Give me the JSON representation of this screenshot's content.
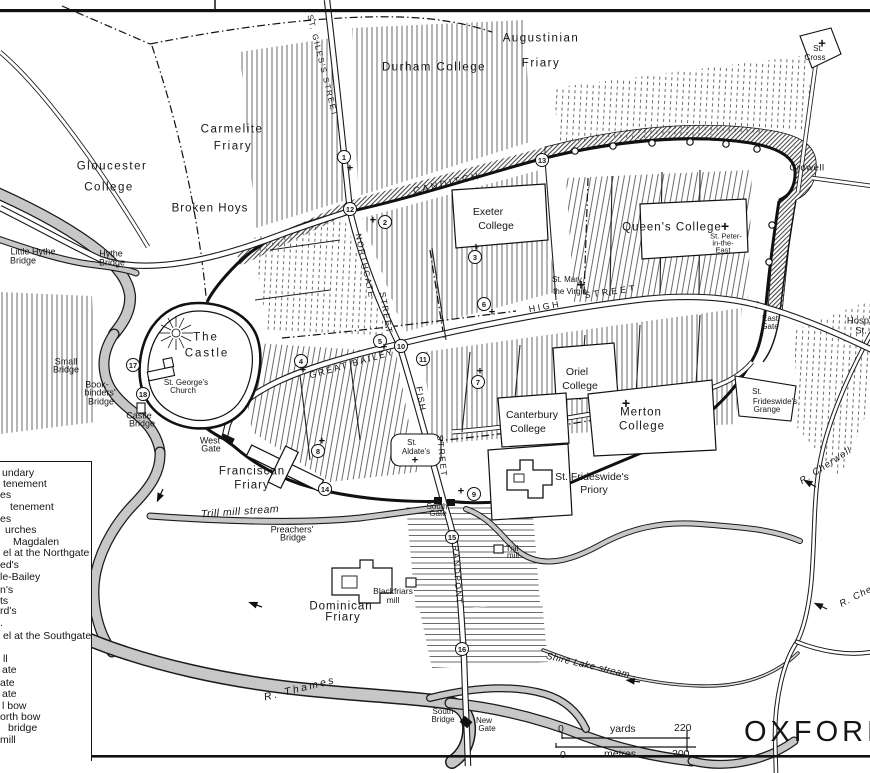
{
  "map": {
    "title": "OXFORD c",
    "colors": {
      "ink": "#1a1a1a",
      "river_gray": "#c7c7c7",
      "paper": "#ffffff"
    },
    "labels": [
      {
        "id": "gloucester-college-1",
        "t": "Gloucester",
        "x": 112,
        "y": 167,
        "s": 11.5,
        "sp": 1.5
      },
      {
        "id": "gloucester-college-2",
        "t": "College",
        "x": 109,
        "y": 188,
        "s": 11.5,
        "sp": 1.5
      },
      {
        "id": "carmelite-friary-1",
        "t": "Carmelite",
        "x": 232,
        "y": 130,
        "s": 11.5,
        "sp": 1.5
      },
      {
        "id": "carmelite-friary-2",
        "t": "Friary",
        "x": 233,
        "y": 147,
        "s": 11.5,
        "sp": 1.5
      },
      {
        "id": "broken-hoys",
        "t": "Broken Hoys",
        "x": 210,
        "y": 209,
        "s": 11.5,
        "sp": 1
      },
      {
        "id": "durham-college",
        "t": "Durham College",
        "x": 434,
        "y": 68,
        "s": 11.5,
        "sp": 1.5
      },
      {
        "id": "augustinian-friary-1",
        "t": "Augustinian",
        "x": 541,
        "y": 39,
        "s": 11.5,
        "sp": 1.5
      },
      {
        "id": "augustinian-friary-2",
        "t": "Friary",
        "x": 541,
        "y": 64,
        "s": 11.5,
        "sp": 1.5
      },
      {
        "id": "st-cross-1",
        "t": "St.",
        "x": 818,
        "y": 49,
        "s": 8
      },
      {
        "id": "st-cross-2",
        "t": "Cross",
        "x": 815,
        "y": 58,
        "s": 8
      },
      {
        "id": "crowell",
        "t": "Crowell",
        "x": 807,
        "y": 168,
        "s": 9.5,
        "sp": 0.5
      },
      {
        "id": "canditch",
        "t": "CANDITCH",
        "x": 447,
        "y": 184,
        "s": 9.5,
        "r": -13,
        "sp": 2.5
      },
      {
        "id": "st-giless-street",
        "t": "ST. GILES'S STREET",
        "x": 322,
        "y": 66,
        "s": 8,
        "r": 76,
        "sp": 1.5
      },
      {
        "id": "exeter-college-1",
        "t": "Exeter",
        "x": 488,
        "y": 212,
        "s": 10.5
      },
      {
        "id": "exeter-college-2",
        "t": "College",
        "x": 496,
        "y": 226,
        "s": 10.5
      },
      {
        "id": "queens-college",
        "t": "Queen's College",
        "x": 672,
        "y": 228,
        "s": 11.5,
        "sp": 1
      },
      {
        "id": "st-peter-east-1",
        "t": "St. Peter-",
        "x": 726,
        "y": 236,
        "s": 7.5
      },
      {
        "id": "st-peter-east-2",
        "t": "in-the-",
        "x": 723,
        "y": 243,
        "s": 7.5
      },
      {
        "id": "st-peter-east-3",
        "t": "East",
        "x": 723,
        "y": 250,
        "s": 7.5
      },
      {
        "id": "st-mary-virgin-1",
        "t": "St. Mary",
        "x": 567,
        "y": 280,
        "s": 8
      },
      {
        "id": "st-mary-virgin-2",
        "t": "the Virgin",
        "x": 570,
        "y": 292,
        "s": 8
      },
      {
        "id": "high-street-1",
        "t": "HIGH",
        "x": 545,
        "y": 307,
        "s": 9,
        "r": -10,
        "sp": 2.5
      },
      {
        "id": "high-street-2",
        "t": "STREET",
        "x": 611,
        "y": 292,
        "s": 9,
        "r": -8,
        "sp": 3
      },
      {
        "id": "northgate-street-1",
        "t": "NORTHGATE",
        "x": 365,
        "y": 266,
        "s": 8.5,
        "r": 78,
        "sp": 1.5
      },
      {
        "id": "northgate-street-2",
        "t": "STREET",
        "x": 386,
        "y": 313,
        "s": 8.5,
        "r": 80,
        "sp": 1.5
      },
      {
        "id": "great-bailey",
        "t": "GREAT BAILEY",
        "x": 352,
        "y": 364,
        "s": 9,
        "r": -16,
        "sp": 2
      },
      {
        "id": "fish-street-1",
        "t": "FISH",
        "x": 421,
        "y": 399,
        "s": 8.5,
        "r": 80,
        "sp": 1.5
      },
      {
        "id": "fish-street-2",
        "t": "STREET",
        "x": 442,
        "y": 456,
        "s": 8.5,
        "r": 84,
        "sp": 1.5
      },
      {
        "id": "grandpont-street",
        "t": "GRANDPONT",
        "x": 457,
        "y": 571,
        "s": 8.5,
        "r": 86,
        "sp": 1.5
      },
      {
        "id": "oriel-college-1",
        "t": "Oriel",
        "x": 577,
        "y": 372,
        "s": 10.5
      },
      {
        "id": "oriel-college-2",
        "t": "College",
        "x": 580,
        "y": 386,
        "s": 10.5
      },
      {
        "id": "canterbury-college-1",
        "t": "Canterbury",
        "x": 532,
        "y": 415,
        "s": 10.5
      },
      {
        "id": "canterbury-college-2",
        "t": "College",
        "x": 528,
        "y": 429,
        "s": 10.5
      },
      {
        "id": "merton-college-1",
        "t": "Merton",
        "x": 641,
        "y": 413,
        "s": 11.5,
        "sp": 1
      },
      {
        "id": "merton-college-2",
        "t": "College",
        "x": 642,
        "y": 427,
        "s": 11.5,
        "sp": 1
      },
      {
        "id": "frideswide-priory-1",
        "t": "St. Frideswide's",
        "x": 592,
        "y": 477,
        "s": 10.5
      },
      {
        "id": "frideswide-priory-2",
        "t": "Priory",
        "x": 594,
        "y": 490,
        "s": 10.5
      },
      {
        "id": "frideswide-grange-1",
        "t": "St.",
        "x": 757,
        "y": 392,
        "s": 8
      },
      {
        "id": "frideswide-grange-2",
        "t": "Frideswide's",
        "x": 775,
        "y": 402,
        "s": 8
      },
      {
        "id": "frideswide-grange-3",
        "t": "Grange",
        "x": 767,
        "y": 410,
        "s": 8
      },
      {
        "id": "east-gate-1",
        "t": "East",
        "x": 770,
        "y": 319,
        "s": 8
      },
      {
        "id": "east-gate-2",
        "t": "Gate",
        "x": 770,
        "y": 327,
        "s": 8
      },
      {
        "id": "hosp-st-1",
        "t": "Hosp",
        "x": 858,
        "y": 321,
        "s": 9.5
      },
      {
        "id": "hosp-st-2",
        "t": "St.",
        "x": 861,
        "y": 331,
        "s": 9.5
      },
      {
        "id": "the-castle-1",
        "t": "The",
        "x": 206,
        "y": 338,
        "s": 11.5,
        "sp": 2
      },
      {
        "id": "the-castle-2",
        "t": "Castle",
        "x": 207,
        "y": 354,
        "s": 11.5,
        "sp": 2
      },
      {
        "id": "st-georges-1",
        "t": "St. George's",
        "x": 186,
        "y": 383,
        "s": 8
      },
      {
        "id": "st-georges-2",
        "t": "Church",
        "x": 183,
        "y": 391,
        "s": 8
      },
      {
        "id": "west-gate-1",
        "t": "West",
        "x": 210,
        "y": 441,
        "s": 9
      },
      {
        "id": "west-gate-2",
        "t": "Gate",
        "x": 211,
        "y": 449,
        "s": 9
      },
      {
        "id": "little-hythe-bridge-1",
        "t": "Little Hythe",
        "x": 33,
        "y": 252,
        "s": 9
      },
      {
        "id": "little-hythe-bridge-2",
        "t": "Bridge",
        "x": 23,
        "y": 261,
        "s": 9
      },
      {
        "id": "hythe-bridge-1",
        "t": "Hythe",
        "x": 111,
        "y": 254,
        "s": 9
      },
      {
        "id": "hythe-bridge-2",
        "t": "Bridge",
        "x": 112,
        "y": 263,
        "s": 9
      },
      {
        "id": "small-bridge-1",
        "t": "Small",
        "x": 66,
        "y": 362,
        "s": 9
      },
      {
        "id": "small-bridge-2",
        "t": "Bridge",
        "x": 66,
        "y": 370,
        "s": 9
      },
      {
        "id": "bookbinders-bridge-1",
        "t": "Book-",
        "x": 97,
        "y": 385,
        "s": 9
      },
      {
        "id": "bookbinders-bridge-2",
        "t": "binders'",
        "x": 100,
        "y": 393,
        "s": 9
      },
      {
        "id": "bookbinders-bridge-3",
        "t": "Bridge",
        "x": 101,
        "y": 402,
        "s": 9
      },
      {
        "id": "castle-bridge-1",
        "t": "Castle",
        "x": 139,
        "y": 416,
        "s": 9
      },
      {
        "id": "castle-bridge-2",
        "t": "Bridge",
        "x": 142,
        "y": 424,
        "s": 9
      },
      {
        "id": "franciscan-friary-1",
        "t": "Franciscan",
        "x": 252,
        "y": 472,
        "s": 11.5,
        "sp": 1
      },
      {
        "id": "franciscan-friary-2",
        "t": "Friary",
        "x": 252,
        "y": 486,
        "s": 11.5,
        "sp": 1
      },
      {
        "id": "st-aldates-1",
        "t": "St.",
        "x": 412,
        "y": 443,
        "s": 8
      },
      {
        "id": "st-aldates-2",
        "t": "Aldate's",
        "x": 416,
        "y": 452,
        "s": 8
      },
      {
        "id": "south-gate-1",
        "t": "South",
        "x": 437,
        "y": 507,
        "s": 8
      },
      {
        "id": "south-gate-2",
        "t": "Gate",
        "x": 438,
        "y": 514,
        "s": 8
      },
      {
        "id": "preachers-bridge-1",
        "t": "Preachers'",
        "x": 292,
        "y": 530,
        "s": 9
      },
      {
        "id": "preachers-bridge-2",
        "t": "Bridge",
        "x": 293,
        "y": 538,
        "s": 9
      },
      {
        "id": "trill-mill-stream",
        "t": "Trill mill stream",
        "x": 240,
        "y": 512,
        "s": 10.5,
        "r": -4,
        "i": 1,
        "sp": 0.5
      },
      {
        "id": "trill-mill-1",
        "t": "Trill",
        "x": 512,
        "y": 549,
        "s": 8
      },
      {
        "id": "trill-mill-2",
        "t": "mill",
        "x": 513,
        "y": 556,
        "s": 8
      },
      {
        "id": "blackfriars-mill-1",
        "t": "Blackfriars",
        "x": 393,
        "y": 591,
        "s": 8.5
      },
      {
        "id": "blackfriars-mill-2",
        "t": "mill",
        "x": 393,
        "y": 600,
        "s": 8.5
      },
      {
        "id": "dominican-friary-1",
        "t": "Dominican",
        "x": 341,
        "y": 607,
        "s": 11.5,
        "sp": 1
      },
      {
        "id": "dominican-friary-2",
        "t": "Friary",
        "x": 343,
        "y": 618,
        "s": 11.5,
        "sp": 1
      },
      {
        "id": "r-thames",
        "t": "R. Thames",
        "x": 300,
        "y": 689,
        "s": 10.5,
        "r": -14,
        "i": 1,
        "sp": 2.5
      },
      {
        "id": "south-bridge-1",
        "t": "South",
        "x": 443,
        "y": 712,
        "s": 8
      },
      {
        "id": "south-bridge-2",
        "t": "Bridge",
        "x": 443,
        "y": 720,
        "s": 8
      },
      {
        "id": "new-gate-1",
        "t": "New",
        "x": 484,
        "y": 721,
        "s": 8
      },
      {
        "id": "new-gate-2",
        "t": "Gate",
        "x": 487,
        "y": 729,
        "s": 8
      },
      {
        "id": "shire-lake-stream",
        "t": "Shire Lake stream",
        "x": 588,
        "y": 666,
        "s": 9.5,
        "r": 13,
        "i": 1,
        "sp": 0.5
      },
      {
        "id": "r-cherwell-1",
        "t": "R. Cherwell",
        "x": 826,
        "y": 466,
        "s": 9.5,
        "r": -33,
        "i": 1,
        "sp": 1
      },
      {
        "id": "r-cherwell-2",
        "t": "R. Cher",
        "x": 858,
        "y": 596,
        "s": 9.5,
        "r": -27,
        "i": 1,
        "sp": 1
      }
    ],
    "markers": [
      {
        "n": "1",
        "x": 344,
        "y": 157
      },
      {
        "n": "2",
        "x": 385,
        "y": 222
      },
      {
        "n": "3",
        "x": 475,
        "y": 257
      },
      {
        "n": "4",
        "x": 301,
        "y": 361
      },
      {
        "n": "5",
        "x": 380,
        "y": 341
      },
      {
        "n": "6",
        "x": 484,
        "y": 304
      },
      {
        "n": "7",
        "x": 478,
        "y": 382
      },
      {
        "n": "8",
        "x": 318,
        "y": 451
      },
      {
        "n": "9",
        "x": 474,
        "y": 494
      },
      {
        "n": "10",
        "x": 401,
        "y": 346
      },
      {
        "n": "11",
        "x": 423,
        "y": 359
      },
      {
        "n": "12",
        "x": 350,
        "y": 209
      },
      {
        "n": "13",
        "x": 542,
        "y": 160
      },
      {
        "n": "14",
        "x": 325,
        "y": 489
      },
      {
        "n": "15",
        "x": 452,
        "y": 537
      },
      {
        "n": "16",
        "x": 462,
        "y": 649
      },
      {
        "n": "17",
        "x": 133,
        "y": 365
      },
      {
        "n": "18",
        "x": 143,
        "y": 394
      }
    ],
    "crosses": [
      {
        "x": 350,
        "y": 169
      },
      {
        "x": 373,
        "y": 221
      },
      {
        "x": 476,
        "y": 248
      },
      {
        "x": 492,
        "y": 313
      },
      {
        "x": 384,
        "y": 348
      },
      {
        "x": 303,
        "y": 371
      },
      {
        "x": 480,
        "y": 372
      },
      {
        "x": 322,
        "y": 442
      },
      {
        "x": 461,
        "y": 492
      },
      {
        "x": 415,
        "y": 461
      },
      {
        "x": 581,
        "y": 285,
        "s": 15
      },
      {
        "x": 725,
        "y": 226,
        "s": 14
      },
      {
        "x": 822,
        "y": 43,
        "s": 13
      },
      {
        "x": 626,
        "y": 403,
        "s": 14
      }
    ]
  },
  "legend": {
    "items": [
      {
        "t": "undary",
        "x": 2,
        "y": 473
      },
      {
        "t": "tenement",
        "x": 3,
        "y": 484
      },
      {
        "t": "es",
        "x": 0,
        "y": 495
      },
      {
        "t": "tenement",
        "x": 10,
        "y": 507
      },
      {
        "t": "es",
        "x": 0,
        "y": 519
      },
      {
        "t": "urches",
        "x": 5,
        "y": 530
      },
      {
        "t": "Magdalen",
        "x": 13,
        "y": 542
      },
      {
        "t": "el at the Northgate",
        "x": 3,
        "y": 553
      },
      {
        "t": "ed's",
        "x": 0,
        "y": 565
      },
      {
        "t": "le-Bailey",
        "x": 0,
        "y": 577
      },
      {
        "t": "n's",
        "x": 0,
        "y": 590
      },
      {
        "t": "ts",
        "x": 0,
        "y": 601
      },
      {
        "t": "rd's",
        "x": 0,
        "y": 611
      },
      {
        "t": ".",
        "x": 0,
        "y": 623
      },
      {
        "t": "el at the Southgate",
        "x": 3,
        "y": 636
      },
      {
        "t": "ll",
        "x": 3,
        "y": 659
      },
      {
        "t": "ate",
        "x": 2,
        "y": 670
      },
      {
        "t": "ate",
        "x": 0,
        "y": 683
      },
      {
        "t": "ate",
        "x": 2,
        "y": 694
      },
      {
        "t": "l bow",
        "x": 2,
        "y": 706
      },
      {
        "t": "orth bow",
        "x": 0,
        "y": 717
      },
      {
        "t": "bridge",
        "x": 8,
        "y": 728
      },
      {
        "t": "mill",
        "x": 0,
        "y": 740
      }
    ]
  },
  "scale": {
    "yards_start": "0",
    "yards_label": "yards",
    "yards_end": "220",
    "metres_start": "0",
    "metres_label": "metres",
    "metres_end": "200"
  }
}
